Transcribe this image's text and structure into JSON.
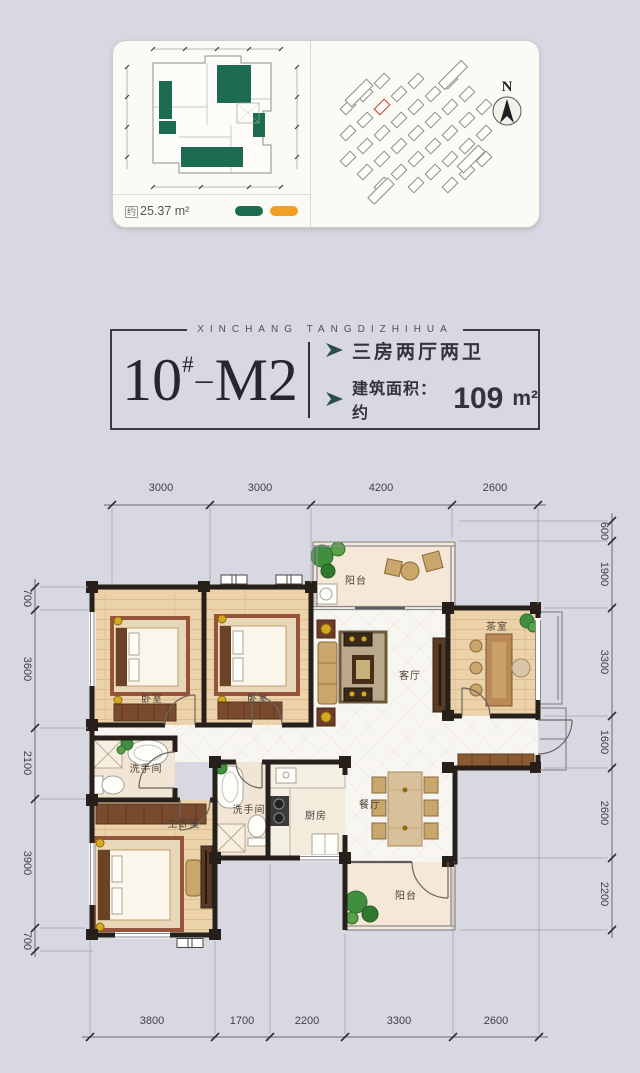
{
  "card": {
    "area_prefix": "约",
    "area_value": "25.37 m²",
    "north_label": "N",
    "legend": {
      "green": "#1c6b50",
      "orange": "#f0a125"
    }
  },
  "title_block": {
    "project_en": "XINCHANG TANGDIZHIHUA",
    "unit_number": "10",
    "unit_hash": "#",
    "unit_sep": "–",
    "unit_model": "M2",
    "spec_rooms": "三房两厅两卫",
    "spec_area_prefix": "建筑面积：约",
    "spec_area_value": "109",
    "spec_area_unit": "m²",
    "accent_color": "#2a4d4d"
  },
  "plan": {
    "rooms": {
      "balcony_top": "阳台",
      "bedroom_1": "卧室",
      "bedroom_2": "卧室",
      "living": "客厅",
      "tea_room": "茶室",
      "bath_1": "洗手间",
      "master_bedroom": "主卧室",
      "bath_2": "洗手间",
      "kitchen": "厨房",
      "dining": "餐厅",
      "balcony_bottom": "阳台"
    },
    "dims_top": [
      "3000",
      "3000",
      "4200",
      "2600"
    ],
    "dims_bottom": [
      "3800",
      "1700",
      "2200",
      "3300",
      "2600"
    ],
    "dims_left": [
      "700",
      "3600",
      "2100",
      "3900",
      "700"
    ],
    "dims_right": [
      "600",
      "1900",
      "3300",
      "1600",
      "2600",
      "2200"
    ]
  }
}
